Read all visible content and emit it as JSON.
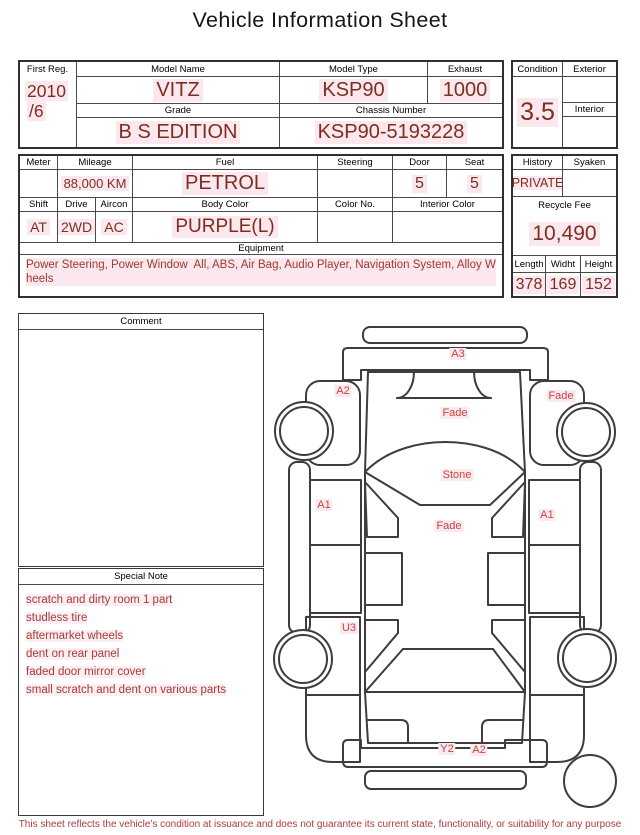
{
  "title": "Vehicle Information Sheet",
  "table1": {
    "first_reg": {
      "label": "First Reg.",
      "value_line1": "2010",
      "value_line2": "/6"
    },
    "model_name": {
      "label": "Model Name",
      "value": "VITZ"
    },
    "model_type": {
      "label": "Model Type",
      "value": "KSP90"
    },
    "exhaust": {
      "label": "Exhaust",
      "value": "1000"
    },
    "grade": {
      "label": "Grade",
      "value": "B S EDITION"
    },
    "chassis_number": {
      "label": "Chassis Number",
      "value": "KSP90-5193228"
    },
    "condition": {
      "label": "Condition",
      "value": "3.5"
    },
    "exterior": {
      "label": "Exterior",
      "value": ""
    },
    "interior": {
      "label": "Interior",
      "value": ""
    }
  },
  "table2": {
    "meter": {
      "label": "Meter",
      "value": ""
    },
    "mileage": {
      "label": "Mileage",
      "value": "88,000 KM"
    },
    "fuel": {
      "label": "Fuel",
      "value": "PETROL"
    },
    "steering": {
      "label": "Steering",
      "value": ""
    },
    "door": {
      "label": "Door",
      "value": "5"
    },
    "seat": {
      "label": "Seat",
      "value": "5"
    },
    "shift": {
      "label": "Shift",
      "value": "AT"
    },
    "drive": {
      "label": "Drive",
      "value": "2WD"
    },
    "aircon": {
      "label": "Aircon",
      "value": "AC"
    },
    "body_color": {
      "label": "Body Color",
      "value": "PURPLE(L)"
    },
    "color_no": {
      "label": "Color No.",
      "value": ""
    },
    "interior_color": {
      "label": "Interior Color",
      "value": ""
    },
    "equipment": {
      "label": "Equipment",
      "value": "Power Steering, Power Window  All, ABS, Air Bag, Audio Player, Navigation System, Alloy Wheels"
    },
    "history": {
      "label": "History",
      "value": "PRIVATE"
    },
    "syaken": {
      "label": "Syaken",
      "value": ""
    },
    "recycle_fee": {
      "label": "Recycle Fee",
      "value": "10,490"
    },
    "length": {
      "label": "Length",
      "value": "378"
    },
    "width": {
      "label": "Widht",
      "value": "169"
    },
    "height": {
      "label": "Height",
      "value": "152"
    }
  },
  "comment": {
    "label": "Comment",
    "value": ""
  },
  "special_note": {
    "label": "Special Note",
    "lines": [
      "scratch and dirty room 1 part",
      "studless tire",
      "aftermarket wheels",
      "dent on rear panel",
      "faded door mirror cover",
      "small scratch and dent on various parts"
    ]
  },
  "diagram": {
    "labels": [
      {
        "text": "A3"
      },
      {
        "text": "A2"
      },
      {
        "text": "Fade"
      },
      {
        "text": "Fade"
      },
      {
        "text": "Stone"
      },
      {
        "text": "A1"
      },
      {
        "text": "A1"
      },
      {
        "text": "Fade"
      },
      {
        "text": "U3"
      },
      {
        "text": "Y2"
      },
      {
        "text": "A2"
      }
    ]
  },
  "disclaimer": "This sheet reflects the vehicle's condition at issuance and does not guarantee its current state, functionality, or suitability for any purpose",
  "colors": {
    "value_text": "#7d2f1f",
    "highlight": "#fbe7ee",
    "note_text": "#a53c36",
    "diagram_label": "#c4463e",
    "disclaimer_text": "#b03a42"
  }
}
